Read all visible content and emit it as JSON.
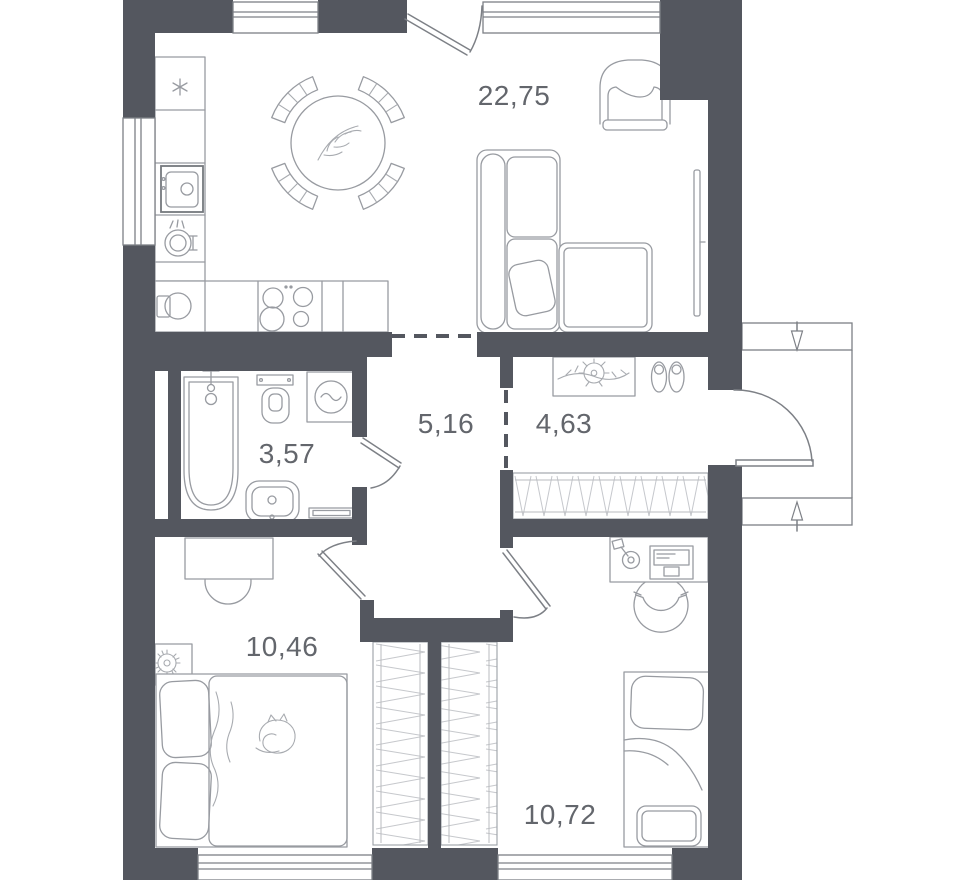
{
  "plan": {
    "title": "apartment-floor-plan",
    "rooms": [
      {
        "name": "kitchen-living-room",
        "area": "22,75"
      },
      {
        "name": "corridor",
        "area": "5,16"
      },
      {
        "name": "hallway",
        "area": "4,63"
      },
      {
        "name": "bathroom",
        "area": "3,57"
      },
      {
        "name": "bedroom-left",
        "area": "10,46"
      },
      {
        "name": "bedroom-right",
        "area": "10,72"
      }
    ],
    "colors": {
      "wall": "#54575F",
      "furniture_line": "#989BA1",
      "label_text": "#63666C",
      "background": "#FFFFFF"
    }
  }
}
